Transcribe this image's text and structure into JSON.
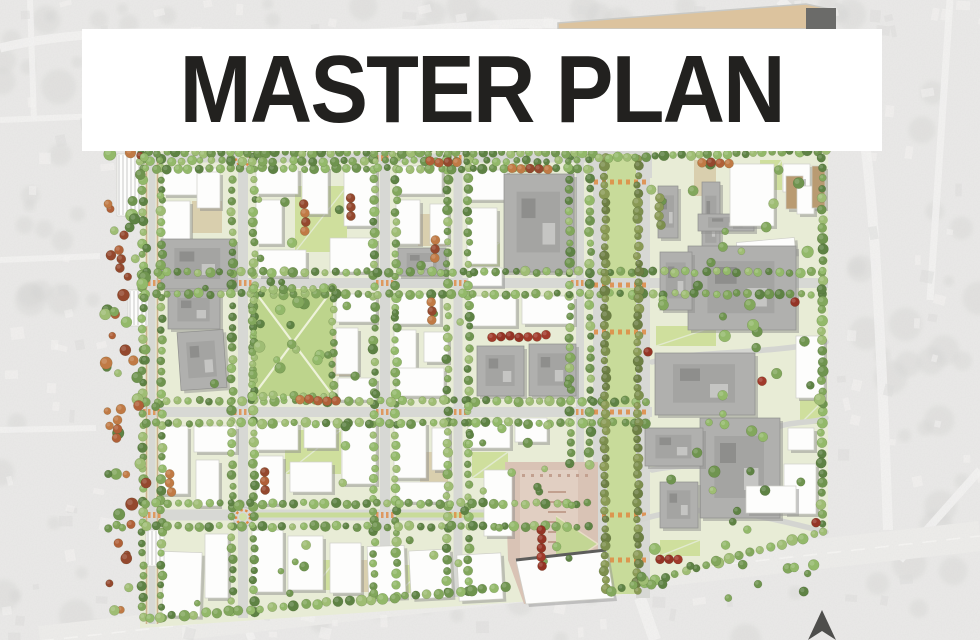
{
  "title": {
    "text": "MASTER PLAN"
  },
  "palette": {
    "aerial_base": "#e4e3e1",
    "aerial_road": "#f1f0ee",
    "aerial_blob": "#c7c7c5",
    "site_ground": "#e8ecd6",
    "street": "#d7d8d4",
    "sidewalk_tan": "#cdb48e",
    "lawn": "#bdd48c",
    "median_lawn": "#c8db9a",
    "courtyard_tan": "#d9cfae",
    "building_white": "#fdfdfc",
    "building_gray": "#b0b0ae",
    "building_tan": "#b99b72",
    "shadow": "#8f8f8d",
    "crosswalk_orange": "#e08a43",
    "plaza_pink": "#d9c3b5",
    "plaza_light": "#e2d1c4",
    "plaza_line": "#c2a08f",
    "tree_greens": [
      "#6f944f",
      "#82a75c",
      "#93b96a",
      "#5e8244",
      "#9fbd74"
    ],
    "tree_olive": [
      "#7d8f4e",
      "#8a9a55",
      "#6d7f44"
    ],
    "tree_orange": [
      "#b06038",
      "#94482e",
      "#c07a45"
    ],
    "tree_red": [
      "#a13a2b",
      "#943325"
    ],
    "north_arrow": "#4e4e4c",
    "wedge_fill": "#dcc39e",
    "wedge_end": "#6b6b69"
  },
  "map": {
    "site_outline": [
      [
        140,
        150
      ],
      [
        828,
        148
      ],
      [
        828,
        530
      ],
      [
        610,
        598
      ],
      [
        518,
        602
      ],
      [
        140,
        628
      ]
    ],
    "top_wedge": {
      "points": [
        [
          558,
          23
        ],
        [
          806,
          4
        ],
        [
          834,
          10
        ],
        [
          834,
          29
        ],
        [
          558,
          29
        ]
      ],
      "end": [
        806,
        8,
        30,
        21
      ]
    },
    "streets": {
      "h": [
        {
          "y": 158,
          "x1": 140,
          "x2": 594,
          "w": 9
        },
        {
          "y": 283,
          "x1": 140,
          "x2": 828,
          "w": 10
        },
        {
          "y": 412,
          "x1": 140,
          "x2": 652,
          "w": 10
        },
        {
          "y": 515,
          "x1": 140,
          "x2": 594,
          "w": 11
        }
      ],
      "v": [
        {
          "x": 152,
          "y1": 150,
          "y2": 624,
          "w": 7,
          "tan": true
        },
        {
          "x": 243,
          "y1": 150,
          "y2": 618,
          "w": 10
        },
        {
          "x": 385,
          "y1": 150,
          "y2": 602,
          "w": 10
        },
        {
          "x": 458,
          "y1": 150,
          "y2": 597,
          "w": 9
        },
        {
          "x": 580,
          "y1": 150,
          "y2": 470,
          "w": 8
        }
      ],
      "boulevard": {
        "x1": 593,
        "lane_w": 14,
        "median_x": 607,
        "median_w": 29,
        "x2": 650,
        "y1": 148,
        "y2": 598,
        "crosswalk_y": [
          182,
          285,
          332,
          412,
          515,
          560
        ],
        "top_pad": [
          588,
          148,
          64,
          30
        ]
      },
      "street_medians": [
        [
          256,
          374,
          515
        ],
        [
          396,
          505,
          515
        ]
      ],
      "intersection_marks": [
        [
          385,
          158
        ],
        [
          458,
          158
        ],
        [
          152,
          283
        ],
        [
          243,
          283
        ],
        [
          385,
          283
        ],
        [
          458,
          283
        ],
        [
          580,
          283
        ],
        [
          152,
          412
        ],
        [
          243,
          412
        ],
        [
          385,
          412
        ],
        [
          458,
          412
        ],
        [
          580,
          412
        ],
        [
          152,
          515
        ],
        [
          385,
          515
        ],
        [
          458,
          515
        ]
      ]
    },
    "roundabouts": [
      [
        243,
        159
      ],
      [
        243,
        517
      ]
    ],
    "park": {
      "x": 253,
      "y": 289,
      "w": 80,
      "h": 107
    },
    "plaza": {
      "poly": [
        [
          505,
          462
        ],
        [
          598,
          462
        ],
        [
          598,
          560
        ],
        [
          610,
          596
        ],
        [
          524,
          604
        ],
        [
          508,
          560
        ]
      ],
      "inner": [
        520,
        470,
        58,
        110
      ],
      "triangle": [
        [
          556,
          516
        ],
        [
          598,
          544
        ],
        [
          556,
          572
        ]
      ],
      "fan_building": [
        [
          516,
          560
        ],
        [
          606,
          550
        ],
        [
          614,
          598
        ],
        [
          526,
          604
        ]
      ],
      "bench_x1": 548,
      "bench_x2": 566,
      "bench_y0": 492,
      "bench_n": 6
    },
    "campus_paths": [
      "M652,362 C700,350 760,355 826,342",
      "M652,470 C690,462 722,468 742,470",
      "M640,520 C700,500 760,515 826,532",
      "M770,430 C790,420 812,424 826,418"
    ],
    "buildings": [
      [
        163,
        168,
        54,
        27,
        "w",
        0
      ],
      [
        163,
        201,
        27,
        46,
        "w",
        0
      ],
      [
        197,
        172,
        23,
        36,
        "w",
        0
      ],
      [
        161,
        239,
        74,
        50,
        "g",
        0
      ],
      [
        168,
        291,
        52,
        38,
        "g",
        0
      ],
      [
        179,
        331,
        46,
        58,
        "g",
        -4
      ],
      [
        256,
        168,
        42,
        26,
        "w",
        0
      ],
      [
        256,
        200,
        26,
        44,
        "w",
        0
      ],
      [
        302,
        166,
        26,
        48,
        "w",
        0
      ],
      [
        344,
        168,
        32,
        58,
        "w",
        0
      ],
      [
        258,
        250,
        48,
        26,
        "w",
        0
      ],
      [
        330,
        238,
        46,
        34,
        "w",
        0
      ],
      [
        396,
        166,
        46,
        28,
        "w",
        0
      ],
      [
        396,
        200,
        24,
        44,
        "w",
        0
      ],
      [
        430,
        204,
        18,
        40,
        "w",
        0
      ],
      [
        398,
        248,
        48,
        28,
        "g",
        0
      ],
      [
        467,
        170,
        40,
        30,
        "w",
        0
      ],
      [
        467,
        208,
        30,
        56,
        "w",
        0
      ],
      [
        504,
        174,
        70,
        98,
        "g",
        0
      ],
      [
        468,
        268,
        34,
        18,
        "w",
        0
      ],
      [
        658,
        186,
        20,
        52,
        "g",
        0
      ],
      [
        702,
        182,
        18,
        76,
        "g",
        0
      ],
      [
        698,
        214,
        56,
        17,
        "g",
        0
      ],
      [
        730,
        164,
        44,
        62,
        "w",
        0
      ],
      [
        783,
        164,
        27,
        28,
        "w",
        0
      ],
      [
        786,
        176,
        17,
        33,
        "t",
        0
      ],
      [
        797,
        186,
        17,
        28,
        "w",
        0
      ],
      [
        737,
        240,
        58,
        16,
        "w",
        -5
      ],
      [
        812,
        166,
        13,
        42,
        "t",
        0
      ],
      [
        336,
        294,
        40,
        28,
        "w",
        0
      ],
      [
        336,
        328,
        22,
        46,
        "w",
        0
      ],
      [
        338,
        378,
        38,
        22,
        "w",
        0
      ],
      [
        394,
        294,
        46,
        30,
        "w",
        0
      ],
      [
        394,
        330,
        22,
        48,
        "w",
        0
      ],
      [
        424,
        332,
        24,
        30,
        "w",
        0
      ],
      [
        396,
        368,
        48,
        28,
        "w",
        0
      ],
      [
        468,
        296,
        48,
        30,
        "w",
        0
      ],
      [
        522,
        296,
        52,
        28,
        "w",
        0
      ],
      [
        477,
        346,
        47,
        50,
        "g",
        0
      ],
      [
        529,
        344,
        47,
        52,
        "g",
        0
      ],
      [
        688,
        246,
        108,
        84,
        "g",
        0
      ],
      [
        660,
        252,
        32,
        58,
        "g",
        0
      ],
      [
        655,
        353,
        100,
        62,
        "g",
        0
      ],
      [
        796,
        336,
        28,
        62,
        "w",
        0
      ],
      [
        700,
        418,
        80,
        100,
        "g",
        0
      ],
      [
        645,
        428,
        58,
        38,
        "g",
        0
      ],
      [
        788,
        428,
        26,
        22,
        "w",
        0
      ],
      [
        784,
        464,
        32,
        50,
        "w",
        0
      ],
      [
        746,
        486,
        50,
        27,
        "w",
        0
      ],
      [
        660,
        482,
        38,
        46,
        "g",
        0
      ],
      [
        160,
        426,
        28,
        68,
        "w",
        0
      ],
      [
        194,
        426,
        42,
        26,
        "w",
        0
      ],
      [
        196,
        460,
        23,
        46,
        "w",
        0
      ],
      [
        256,
        422,
        42,
        28,
        "w",
        0
      ],
      [
        304,
        422,
        32,
        26,
        "w",
        0
      ],
      [
        342,
        422,
        34,
        62,
        "w",
        0
      ],
      [
        256,
        456,
        27,
        48,
        "w",
        0
      ],
      [
        290,
        462,
        42,
        30,
        "w",
        0
      ],
      [
        394,
        422,
        32,
        56,
        "w",
        0
      ],
      [
        432,
        428,
        17,
        42,
        "w",
        0
      ],
      [
        396,
        482,
        50,
        20,
        "w",
        0
      ],
      [
        468,
        422,
        42,
        26,
        "w",
        0
      ],
      [
        515,
        418,
        32,
        24,
        "w",
        0
      ],
      [
        484,
        470,
        28,
        66,
        "w",
        0
      ],
      [
        163,
        552,
        38,
        64,
        "w",
        2
      ],
      [
        205,
        534,
        23,
        64,
        "w",
        0
      ],
      [
        252,
        530,
        31,
        62,
        "w",
        0
      ],
      [
        288,
        536,
        35,
        54,
        "w",
        0
      ],
      [
        330,
        543,
        31,
        50,
        "w",
        0
      ],
      [
        368,
        546,
        37,
        52,
        "w",
        -2
      ],
      [
        410,
        550,
        41,
        48,
        "w",
        -3
      ],
      [
        458,
        554,
        44,
        46,
        "w",
        -3
      ],
      [
        117,
        154,
        24,
        62,
        "p",
        0
      ],
      [
        128,
        290,
        20,
        36,
        "p",
        0
      ],
      [
        146,
        530,
        18,
        36,
        "p",
        0
      ]
    ],
    "courtyards": [
      [
        295,
        186,
        52,
        66,
        "lawn"
      ],
      [
        192,
        201,
        30,
        32,
        "tan"
      ],
      [
        418,
        214,
        28,
        32,
        "tan"
      ],
      [
        470,
        242,
        30,
        24,
        "lawn"
      ],
      [
        333,
        330,
        24,
        46,
        "dots"
      ],
      [
        285,
        430,
        56,
        44,
        "lawn"
      ],
      [
        420,
        452,
        28,
        30,
        "tan"
      ],
      [
        472,
        452,
        36,
        26,
        "lawn"
      ],
      [
        312,
        560,
        24,
        30,
        "lawn"
      ],
      [
        352,
        560,
        26,
        32,
        "tan"
      ],
      [
        398,
        565,
        30,
        28,
        "lawn"
      ],
      [
        694,
        160,
        22,
        36,
        "tan"
      ],
      [
        656,
        326,
        60,
        20,
        "lawn"
      ],
      [
        800,
        400,
        24,
        24,
        "lawn"
      ],
      [
        760,
        160,
        22,
        30,
        "lawn"
      ],
      [
        525,
        178,
        40,
        30,
        "lawn"
      ],
      [
        660,
        540,
        40,
        16,
        "lawn"
      ]
    ],
    "tree_clusters": [
      [
        305,
        204,
        4,
        "v",
        "orange"
      ],
      [
        352,
        198,
        3,
        "v",
        "orange"
      ],
      [
        430,
        162,
        4,
        "h",
        "orange"
      ],
      [
        512,
        168,
        5,
        "h",
        "orange"
      ],
      [
        434,
        240,
        3,
        "v",
        "orange"
      ],
      [
        492,
        336,
        7,
        "h",
        "red"
      ],
      [
        300,
        400,
        5,
        "h",
        "orange"
      ],
      [
        264,
        472,
        3,
        "v",
        "orange"
      ],
      [
        170,
        474,
        3,
        "v",
        "orange"
      ],
      [
        432,
        302,
        3,
        "v",
        "orange"
      ],
      [
        660,
        198,
        4,
        "v",
        "olive"
      ],
      [
        702,
        162,
        4,
        "h",
        "orange"
      ],
      [
        541,
        530,
        5,
        "v",
        "red"
      ],
      [
        120,
        250,
        3,
        "v",
        "orange"
      ],
      [
        118,
        420,
        3,
        "v",
        "orange"
      ],
      [
        660,
        560,
        3,
        "h",
        "red"
      ],
      [
        795,
        302,
        1,
        "h",
        "red"
      ],
      [
        762,
        382,
        1,
        "h",
        "red"
      ],
      [
        816,
        524,
        1,
        "h",
        "red"
      ],
      [
        648,
        352,
        1,
        "h",
        "red"
      ]
    ],
    "extra_tree_rows": [
      [
        140,
        153,
        592,
        153,
        9,
        4.2,
        "g"
      ],
      [
        140,
        161,
        588,
        161,
        10,
        3.8,
        "g"
      ],
      [
        600,
        158,
        826,
        151,
        9,
        4.4,
        "g"
      ],
      [
        822,
        158,
        822,
        524,
        10,
        4.4,
        "g"
      ],
      [
        150,
        618,
        505,
        588,
        11,
        4.6,
        "g"
      ],
      [
        612,
        592,
        824,
        532,
        11,
        4.6,
        "g"
      ],
      [
        253,
        289,
        333,
        289,
        10,
        3.9,
        "g"
      ],
      [
        253,
        396,
        333,
        396,
        10,
        3.9,
        "g"
      ],
      [
        253,
        289,
        253,
        396,
        10,
        3.9,
        "g"
      ],
      [
        333,
        289,
        333,
        396,
        10,
        3.9,
        "g"
      ]
    ],
    "tree_scatter": [
      [
        104,
        152,
        44,
        460,
        60,
        "mix",
        3.5,
        6.5
      ],
      [
        650,
        150,
        175,
        400,
        45,
        "g",
        3.5,
        6
      ],
      [
        255,
        292,
        76,
        100,
        12,
        "g",
        3.5,
        6
      ],
      [
        150,
        165,
        430,
        440,
        40,
        "g",
        3,
        5
      ],
      [
        460,
        420,
        120,
        120,
        12,
        "g",
        3,
        5
      ],
      [
        620,
        560,
        200,
        40,
        14,
        "g",
        3.5,
        5.5
      ]
    ],
    "aerial_roads": [
      {
        "d": "M0,48 C120,18 260,44 420,30 C480,25 530,22 560,24",
        "w": 9
      },
      {
        "d": "M780,0 C800,20 830,40 846,60 C870,100 880,300 888,530",
        "w": 10
      },
      {
        "d": "M950,0 L930,300",
        "w": 7
      },
      {
        "d": "M0,120 L100,116",
        "w": 6
      },
      {
        "d": "M0,260 L100,256",
        "w": 6
      },
      {
        "d": "M0,430 L96,428",
        "w": 6
      },
      {
        "d": "M30,0 L34,120",
        "w": 6
      },
      {
        "d": "M900,560 L980,470",
        "w": 8
      },
      {
        "d": "M243,615 L252,640",
        "w": 8
      },
      {
        "d": "M640,598 L655,640",
        "w": 12
      }
    ],
    "arterial": {
      "x1": 40,
      "y1": 641,
      "x2": 980,
      "y2": 536,
      "w": 30
    },
    "north_arrow": [
      [
        822,
        610
      ],
      [
        808,
        640
      ],
      [
        822,
        631
      ],
      [
        836,
        640
      ]
    ]
  }
}
